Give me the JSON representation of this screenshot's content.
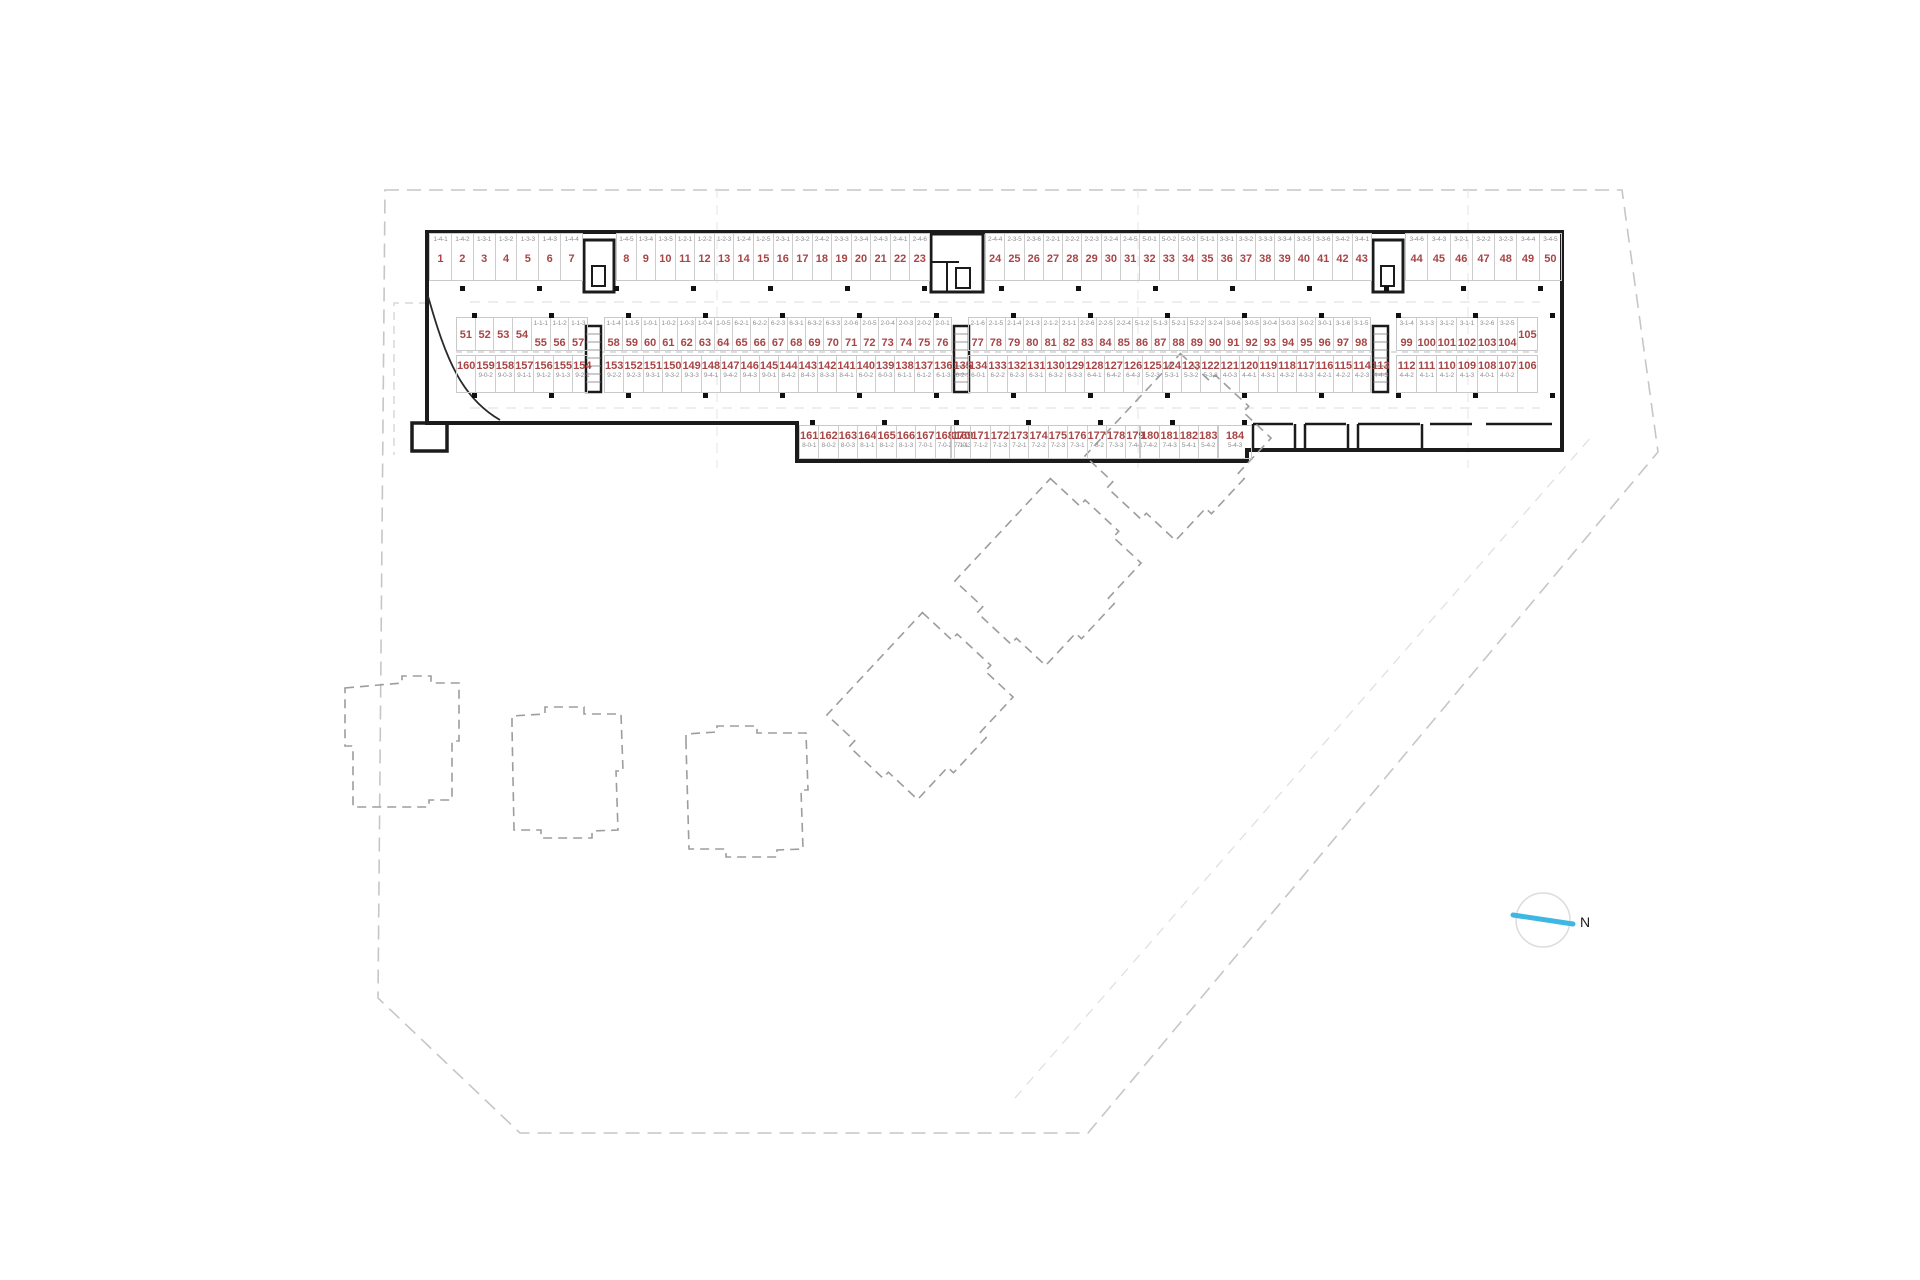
{
  "title": "Underground parking floor plan",
  "north_label": "N",
  "colors": {
    "stall_number": "#a84545",
    "code_text": "#8f8f8f",
    "wall": "#1b1b1b",
    "boundary_dash": "#c6c6c6",
    "building_dash": "#9d9d9d",
    "north_arrow": "#3eb7e2"
  },
  "parking_rows": {
    "row_top": {
      "segments": [
        {
          "stalls": [
            1,
            2,
            3,
            4,
            5,
            6,
            7
          ],
          "codes": [
            "1-4-1",
            "1-4-2",
            "1-3-1",
            "1-3-2",
            "1-3-3",
            "1-4-3",
            "1-4-4"
          ]
        },
        {
          "stalls": [
            8,
            9,
            10,
            11,
            12,
            13,
            14,
            15,
            16,
            17,
            18,
            19,
            20,
            21,
            22,
            23
          ],
          "codes": [
            "1-4-5",
            "1-3-4",
            "1-3-5",
            "1-2-1",
            "1-2-2",
            "1-2-3",
            "1-2-4",
            "1-2-5",
            "2-3-1",
            "2-3-2",
            "2-4-2",
            "2-3-3",
            "2-3-4",
            "2-4-3",
            "2-4-1",
            "2-4-6"
          ]
        },
        {
          "stalls": [
            24,
            25,
            26,
            27,
            28,
            29,
            30,
            31,
            32,
            33,
            34,
            35,
            36,
            37,
            38,
            39,
            40,
            41,
            42,
            43
          ],
          "codes": [
            "2-4-4",
            "2-3-5",
            "2-3-6",
            "2-2-1",
            "2-2-2",
            "2-2-3",
            "2-2-4",
            "2-4-5",
            "5-0-1",
            "5-0-2",
            "5-0-3",
            "5-1-1",
            "3-3-1",
            "3-3-2",
            "3-3-3",
            "3-3-4",
            "3-3-5",
            "3-3-6",
            "3-4-2",
            "3-4-1"
          ]
        },
        {
          "stalls": [
            44,
            45,
            46,
            47,
            48,
            49,
            50
          ],
          "codes": [
            "3-4-6",
            "3-4-3",
            "3-2-1",
            "3-2-2",
            "3-2-3",
            "3-4-4",
            "3-4-5"
          ]
        }
      ]
    },
    "row_upper_middle": {
      "segments": [
        {
          "stalls": [
            51,
            52,
            53,
            54,
            55,
            56,
            57
          ],
          "codes": [
            "",
            "",
            "",
            "",
            "1-1-1",
            "1-1-2",
            "1-1-3"
          ]
        },
        {
          "stalls": [
            58,
            59,
            60,
            61,
            62,
            63,
            64,
            65,
            66,
            67,
            68,
            69,
            70,
            71,
            72,
            73,
            74,
            75,
            76
          ],
          "codes": [
            "1-1-4",
            "1-1-5",
            "1-0-1",
            "1-0-2",
            "1-0-3",
            "1-0-4",
            "1-0-5",
            "6-2-1",
            "6-2-2",
            "6-2-3",
            "6-3-1",
            "6-3-2",
            "6-3-3",
            "2-0-6",
            "2-0-5",
            "2-0-4",
            "2-0-3",
            "2-0-2",
            "2-0-1"
          ]
        },
        {
          "stalls": [
            77,
            78,
            79,
            80,
            81,
            82,
            83,
            84,
            85,
            86,
            87,
            88,
            89,
            90,
            91,
            92,
            93,
            94,
            95,
            96,
            97,
            98
          ],
          "codes": [
            "2-1-6",
            "2-1-5",
            "2-1-4",
            "2-1-3",
            "2-1-2",
            "2-1-1",
            "2-2-6",
            "2-2-5",
            "2-2-4",
            "5-1-2",
            "5-1-3",
            "5-2-1",
            "5-2-2",
            "3-2-4",
            "3-0-6",
            "3-0-5",
            "3-0-4",
            "3-0-3",
            "3-0-2",
            "3-0-1",
            "3-1-6",
            "3-1-5"
          ]
        },
        {
          "stalls": [
            99,
            100,
            101,
            102,
            103,
            104,
            105
          ],
          "codes": [
            "3-1-4",
            "3-1-3",
            "3-1-2",
            "3-1-1",
            "3-2-6",
            "3-2-5",
            ""
          ]
        }
      ]
    },
    "row_lower_middle": {
      "segments": [
        {
          "stalls": [
            160,
            159,
            158,
            157,
            156,
            155,
            154
          ],
          "codes": [
            "",
            "9-0-2",
            "9-0-3",
            "9-1-1",
            "9-1-2",
            "9-1-3",
            "9-2-1"
          ]
        },
        {
          "stalls": [
            153,
            152,
            151,
            150,
            149,
            148,
            147,
            146,
            145,
            144,
            143,
            142,
            141,
            140,
            139,
            138,
            137,
            136,
            135
          ],
          "codes": [
            "9-2-2",
            "9-2-3",
            "9-3-1",
            "9-3-2",
            "9-3-3",
            "9-4-1",
            "9-4-2",
            "9-4-3",
            "9-0-1",
            "8-4-2",
            "8-4-3",
            "8-3-3",
            "8-4-1",
            "6-0-2",
            "6-0-3",
            "6-1-1",
            "6-1-2",
            "6-1-3",
            "6-2-1"
          ]
        },
        {
          "stalls": [
            134,
            133,
            132,
            131,
            130,
            129,
            128,
            127,
            126,
            125,
            124,
            123,
            122,
            121,
            120,
            119,
            118,
            117,
            116,
            115,
            114,
            113
          ],
          "codes": [
            "6-0-1",
            "6-2-2",
            "6-2-3",
            "6-3-1",
            "6-3-2",
            "6-3-3",
            "6-4-1",
            "6-4-2",
            "6-4-3",
            "5-2-3",
            "5-3-1",
            "5-3-2",
            "5-3-3",
            "4-0-3",
            "4-4-1",
            "4-3-1",
            "4-3-2",
            "4-3-3",
            "4-2-1",
            "4-2-2",
            "4-2-3",
            "4-4-3"
          ]
        },
        {
          "stalls": [
            112,
            111,
            110,
            109,
            108,
            107,
            106
          ],
          "codes": [
            "4-4-2",
            "4-1-1",
            "4-1-2",
            "4-1-3",
            "4-0-1",
            "4-0-2",
            ""
          ]
        }
      ]
    },
    "row_bottom": {
      "segments": [
        {
          "stalls": [
            161,
            162,
            163,
            164,
            165,
            166,
            167,
            168,
            169
          ],
          "codes": [
            "8-0-1",
            "8-0-2",
            "8-0-3",
            "8-1-1",
            "8-1-2",
            "8-1-3",
            "7-0-1",
            "7-0-2",
            "7-0-3"
          ]
        },
        {
          "stalls": [
            170,
            171,
            172,
            173,
            174,
            175,
            176,
            177,
            178,
            179
          ],
          "codes": [
            "7-1-1",
            "7-1-2",
            "7-1-3",
            "7-2-1",
            "7-2-2",
            "7-2-3",
            "7-3-1",
            "7-3-2",
            "7-3-3",
            "7-4-1"
          ]
        },
        {
          "stalls": [
            180,
            181,
            182,
            183
          ],
          "codes": [
            "7-4-2",
            "7-4-3",
            "5-4-1",
            "5-4-2"
          ]
        },
        {
          "stalls": [
            184
          ],
          "codes": [
            "5-4-3"
          ]
        }
      ]
    }
  }
}
